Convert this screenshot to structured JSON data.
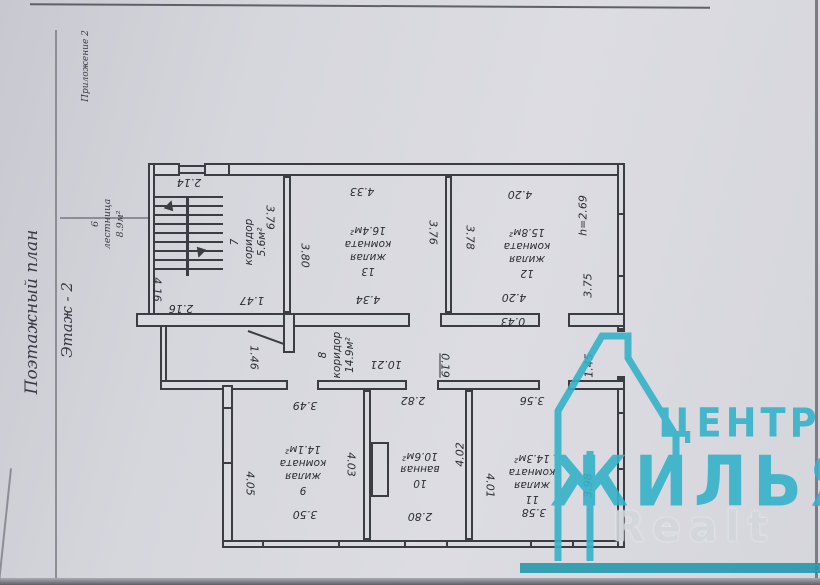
{
  "page": {
    "appendix": "Приложение 2",
    "title": "Поэтажный план",
    "subtitle": "Этаж - 2"
  },
  "watermark": {
    "brand_top": "ЦЕНТР",
    "brand_bottom": "ЖИЛЬЯ",
    "brand_latin": "Realt",
    "accent_color": "#35b2c8"
  },
  "plan": {
    "rooms": {
      "r6": {
        "num": "6",
        "name": "лестница",
        "area": "8.9м²"
      },
      "r7": {
        "num": "7",
        "name": "коридор",
        "area": "5.6м²"
      },
      "r8": {
        "num": "8",
        "name": "коридор",
        "area": "14.9м²"
      },
      "r9": {
        "num": "9",
        "name": "жилая",
        "name2": "комната",
        "area": "14.1м²"
      },
      "r10": {
        "num": "10",
        "name": "ванная",
        "area": "10.6м²"
      },
      "r11": {
        "num": "11",
        "name": "жилая",
        "name2": "комната",
        "area": "14.3м²"
      },
      "r12": {
        "num": "12",
        "name": "жилая",
        "name2": "комната",
        "area": "15.8м²"
      },
      "r13": {
        "num": "13",
        "name": "жилая",
        "name2": "комната",
        "area": "16.4м²"
      }
    },
    "dims": {
      "d214": "2.14",
      "d416": "4.16",
      "d216": "2.16",
      "d379": "3.79",
      "d147": "1.47",
      "d146": "1.46",
      "d433": "4.33",
      "d380": "3.80",
      "d376": "3.76",
      "d434": "4.34",
      "d420a": "4.20",
      "d378": "3.78",
      "dh269": "h=2.69",
      "d375": "3.75",
      "d420b": "4.20",
      "d043": "0.43",
      "d1021": "10.21",
      "d019": "0.19",
      "d145": "1.45",
      "d349": "3.49",
      "d282": "2.82",
      "d356": "3.56",
      "d405": "4.05",
      "d403": "4.03",
      "d402": "4.02",
      "d401": "4.01",
      "d398": "3.98",
      "d350": "3.50",
      "d280": "2.80",
      "d358": "3.58"
    }
  }
}
